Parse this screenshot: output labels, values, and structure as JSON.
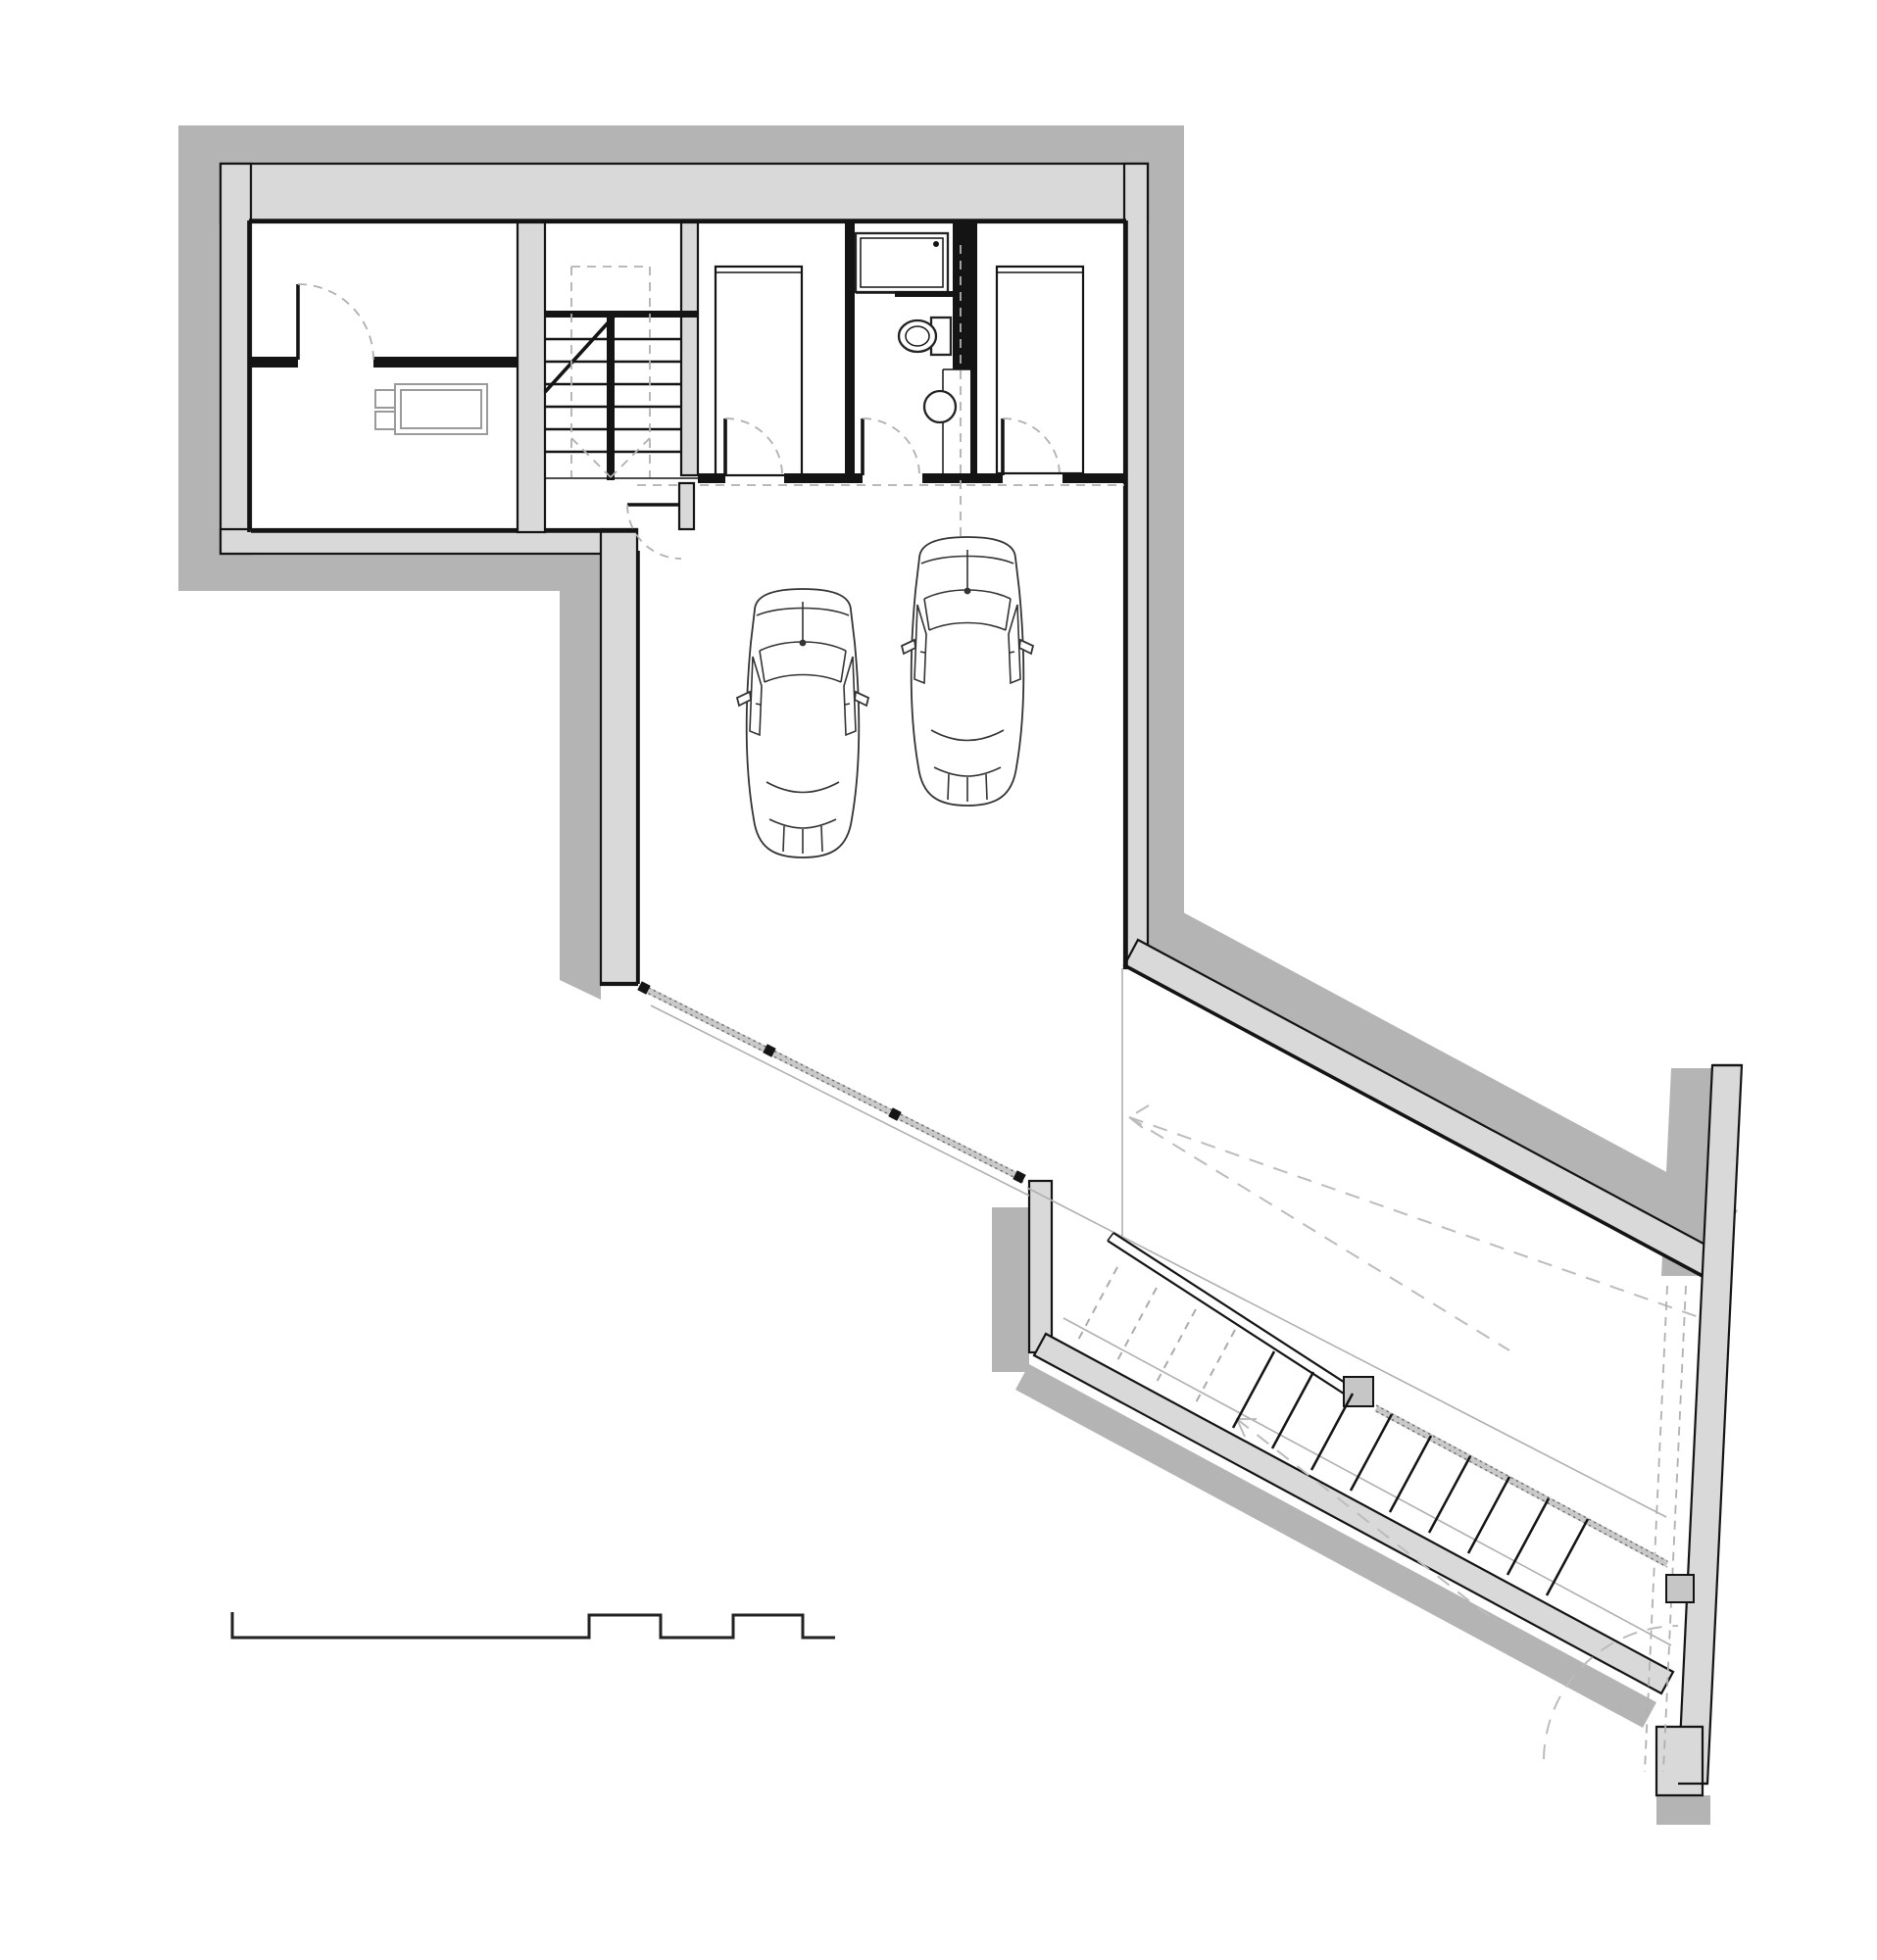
{
  "drawing": {
    "type": "architectural floor plan — basement / garage level",
    "palette": {
      "paper": "#ffffff",
      "earth_band": "#b4b4b4",
      "wall_fill": "#d9d9d9",
      "line": "#141414",
      "light_line": "#b0b0b0",
      "fixture_gray": "#9a9a9a"
    },
    "elements": {
      "cars": 2,
      "rooms": [
        "entry-room",
        "boiler-room",
        "stairwell",
        "storage-room-left",
        "bathroom",
        "storage-room-right",
        "two-car-garage",
        "driveway-ramp-court"
      ],
      "bathroom_fixtures": [
        "shower-tray",
        "toilet",
        "round-washbasin"
      ],
      "interior_doors": 6,
      "stair_flights_interior": 2,
      "stair_treads_interior_per_flight": 7,
      "outdoor_stair_treads_solid": 9,
      "outdoor_stair_treads_hidden": 4,
      "glazed_front_mullions": 4,
      "railing_posts": 2,
      "appliances": [
        "boiler-tank"
      ]
    }
  }
}
